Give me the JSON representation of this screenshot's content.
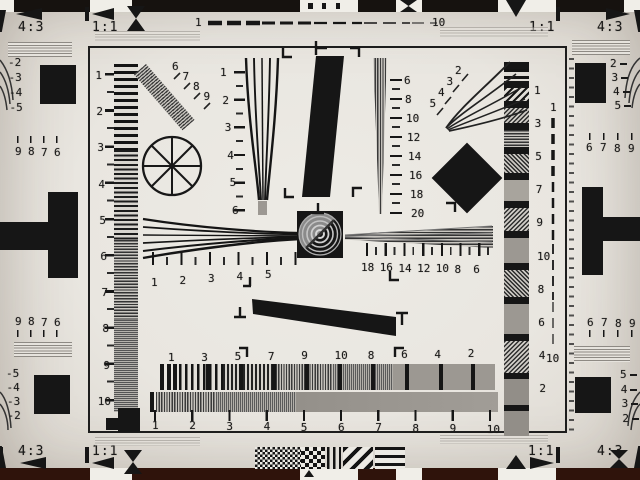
{
  "corners": {
    "top_left": {
      "aspect": "4:3",
      "unity": "1:1"
    },
    "top_right": {
      "unity": "1:1",
      "aspect": "4:3"
    },
    "bottom_left": {
      "aspect": "4:3",
      "unity": "1:1"
    },
    "bottom_right": {
      "unity": "1:1",
      "aspect": "4:3"
    }
  },
  "top_dashed_ruler": {
    "start": "1",
    "end": "10"
  },
  "right_dashed_ruler": {
    "start": "1",
    "end": "10"
  },
  "left_margin": {
    "upper_wedge_labels": [
      "-2",
      "-3",
      "-4",
      "-5"
    ],
    "upper_digits": [
      "9",
      "8",
      "7",
      "6"
    ],
    "lower_digits": [
      "9",
      "8",
      "7",
      "6"
    ],
    "lower_wedge_labels": [
      "-5",
      "-4",
      "-3",
      "-2"
    ]
  },
  "right_margin": {
    "upper_wedge_labels": [
      "2",
      "3",
      "4",
      "5"
    ],
    "upper_digits": [
      "6",
      "7",
      "8",
      "9"
    ],
    "lower_digits": [
      "6",
      "7",
      "8",
      "9"
    ],
    "lower_wedge_labels": [
      "5",
      "4",
      "3",
      "2"
    ]
  },
  "scales": {
    "left_ruler": [
      "1",
      "2",
      "3",
      "4",
      "5",
      "6",
      "7",
      "8",
      "9",
      "10"
    ],
    "center_vertical_wedge": [
      "1",
      "2",
      "3",
      "4",
      "5",
      "6"
    ],
    "center_vertical_wedge_right": [
      "6",
      "8",
      "10",
      "12",
      "14",
      "16",
      "18",
      "20"
    ],
    "upper_left_diagonal_fan": [
      "6",
      "7",
      "8",
      "9"
    ],
    "upper_right_fan": [
      "2",
      "3",
      "4",
      "5"
    ],
    "horizontal_wedge_left": [
      "1",
      "2",
      "3",
      "4",
      "5"
    ],
    "horizontal_wedge_right": [
      "18",
      "16",
      "14",
      "12",
      "10",
      "8",
      "6"
    ],
    "right_burst_column": [
      "1",
      "3",
      "5",
      "7",
      "9",
      "10",
      "8",
      "6",
      "4",
      "2"
    ],
    "bottom_burst_labels": [
      "1",
      "3",
      "5",
      "7",
      "9",
      "10",
      "8",
      "6",
      "4",
      "2"
    ],
    "bottom_ruler": [
      "1",
      "2",
      "3",
      "4",
      "5",
      "6",
      "7",
      "8",
      "9",
      "10"
    ]
  }
}
